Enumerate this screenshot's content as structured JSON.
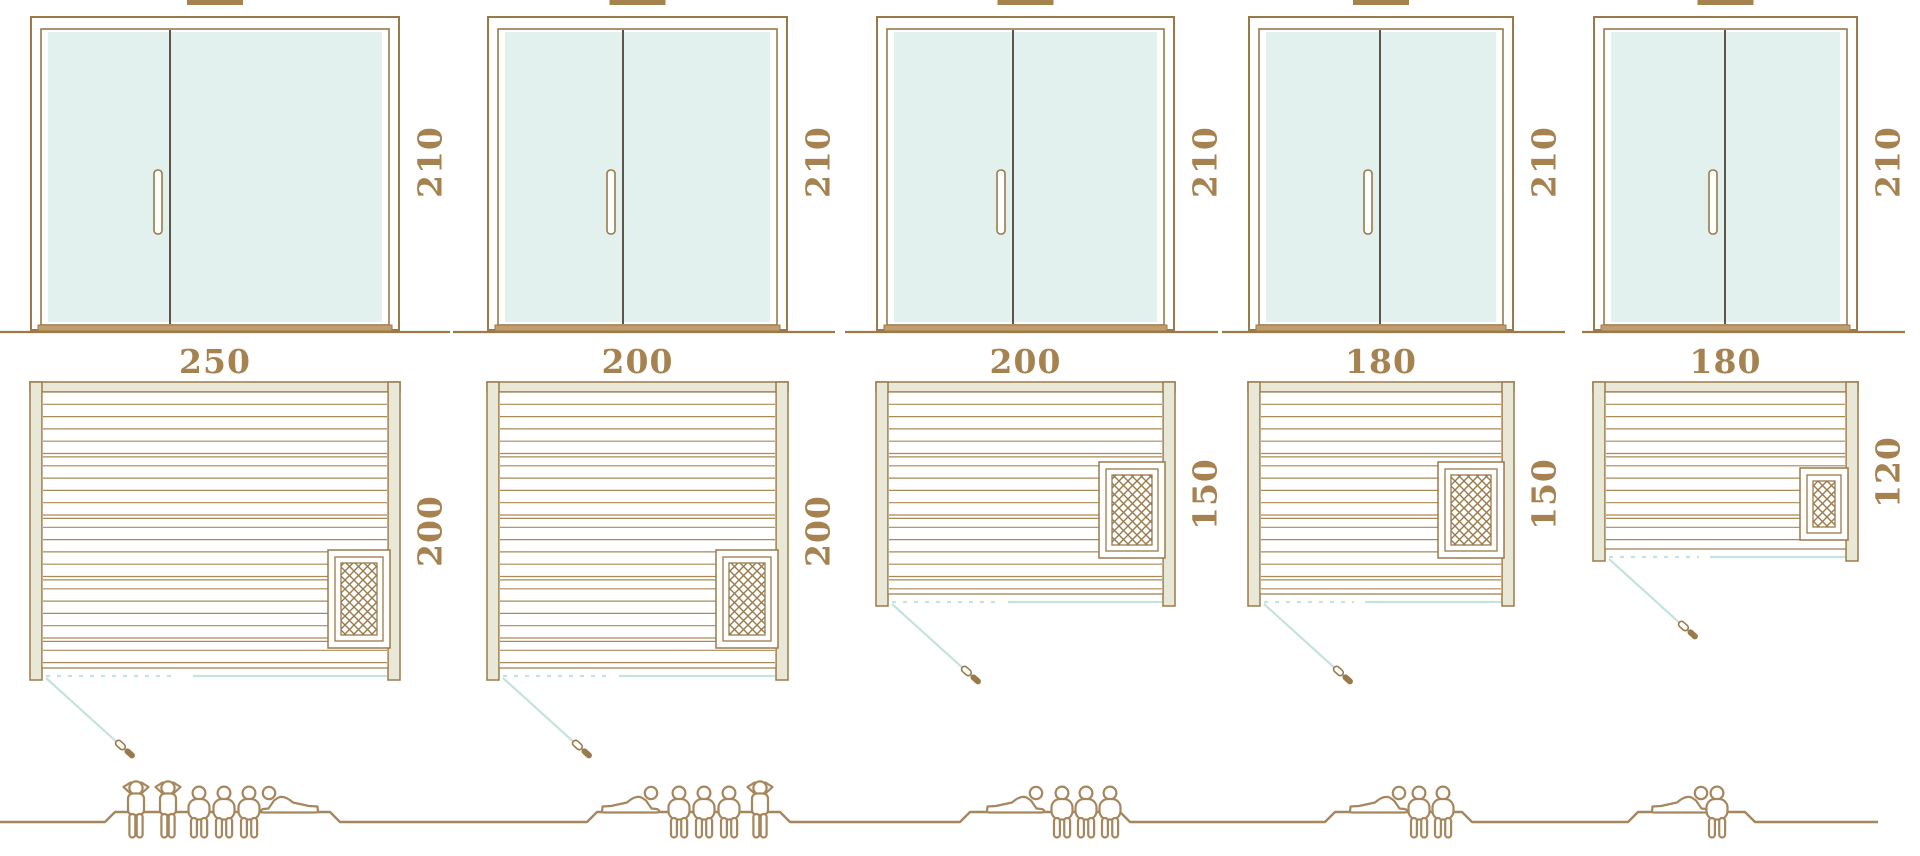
{
  "diagram": {
    "type": "sauna-size-comparison",
    "units": [
      {
        "name": "sauna-250x200",
        "door_height": "210",
        "width": "250",
        "depth": "200",
        "door_height_cm": 210,
        "width_cm": 250,
        "depth_cm": 200,
        "capacity": {
          "total": 6,
          "standing": 2,
          "seated": 3,
          "reclining": 1,
          "figures": [
            "standing",
            "standing",
            "seated",
            "seated",
            "seated",
            "reclining"
          ]
        }
      },
      {
        "name": "sauna-200x200",
        "door_height": "210",
        "width": "200",
        "depth": "200",
        "door_height_cm": 210,
        "width_cm": 200,
        "depth_cm": 200,
        "capacity": {
          "total": 5,
          "standing": 1,
          "seated": 3,
          "reclining": 1,
          "figures": [
            "reclining",
            "seated",
            "seated",
            "seated",
            "standing"
          ]
        }
      },
      {
        "name": "sauna-200x150",
        "door_height": "210",
        "width": "200",
        "depth": "150",
        "door_height_cm": 210,
        "width_cm": 200,
        "depth_cm": 150,
        "capacity": {
          "total": 4,
          "standing": 0,
          "seated": 3,
          "reclining": 1,
          "figures": [
            "reclining",
            "seated",
            "seated",
            "seated"
          ]
        }
      },
      {
        "name": "sauna-180x150",
        "door_height": "210",
        "width": "180",
        "depth": "150",
        "door_height_cm": 210,
        "width_cm": 180,
        "depth_cm": 150,
        "capacity": {
          "total": 3,
          "standing": 0,
          "seated": 2,
          "reclining": 1,
          "figures": [
            "reclining",
            "seated",
            "seated"
          ]
        }
      },
      {
        "name": "sauna-180x120",
        "door_height": "210",
        "width": "180",
        "depth": "120",
        "door_height_cm": 210,
        "width_cm": 180,
        "depth_cm": 120,
        "capacity": {
          "total": 2,
          "standing": 0,
          "seated": 1,
          "reclining": 1,
          "figures": [
            "reclining",
            "seated"
          ]
        }
      }
    ],
    "colors": {
      "outline": "#9a7a4a",
      "label": "#a5824f",
      "glass": "#e3f1ee",
      "wall_fill": "#e9e7d5",
      "boards": "#a98956",
      "door_swing_teal": "#c5e3dd",
      "door_divider": "#5d554a",
      "threshold": "#c09d6b",
      "figure": "#a6865c",
      "roof_cap": "#a5824e",
      "background": "#ffffff"
    },
    "icons": [
      "door-elevation",
      "door-handle",
      "floor-plan",
      "heater-icon",
      "door-swing-dashed-line",
      "door-swing-line",
      "plan-door-handle",
      "standing-person-icon",
      "seated-person-icon",
      "reclining-person-icon",
      "ground-line",
      "platform-ground-line",
      "roof-cap-bar"
    ]
  }
}
